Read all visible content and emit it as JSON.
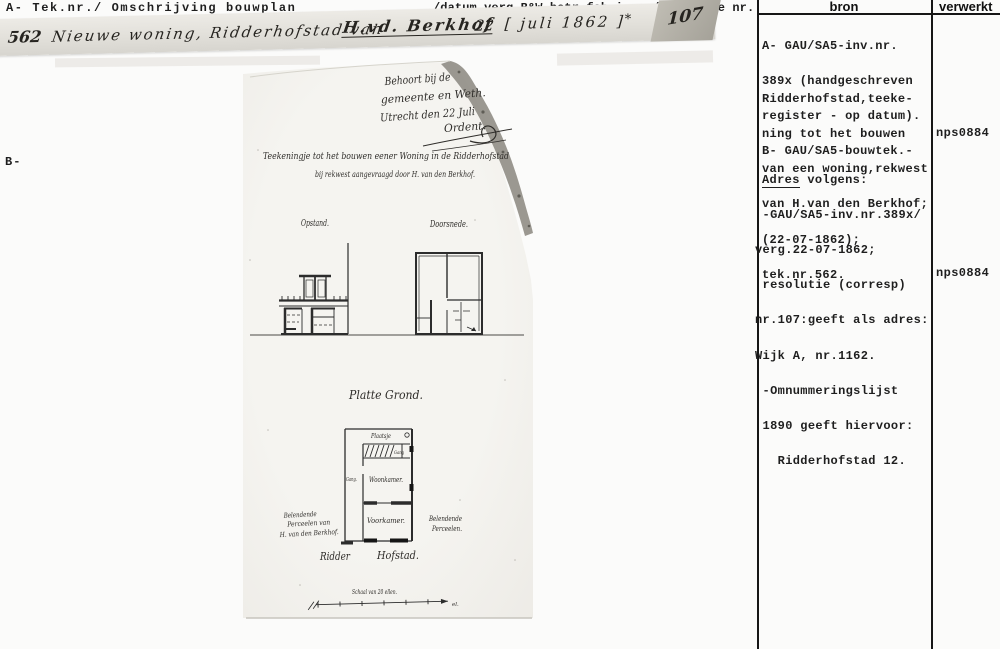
{
  "header": {
    "left": "A- Tek.nr./ Omschrijving bouwplan",
    "middle": "/datum verg.B&W.betr.fabricage/resolutie nr.",
    "bron": "bron",
    "verwerkt": "verwerkt",
    "b_label": "B-"
  },
  "entry": {
    "tek_nr": "562",
    "text": "Nieuwe woning, Ridderhofstad van",
    "name": "H.vd. Berkhof",
    "day": "22",
    "date": "[ juli 1862 ]",
    "mark": "*",
    "resolutie": "107"
  },
  "bron": {
    "block1": {
      "0": "A- GAU/SA5-inv.nr.",
      "1": "389x (handgeschreven",
      "2": "register - op datum).",
      "3": "B- GAU/SA5-bouwtek.-"
    },
    "block2": {
      "0": "Ridderhofstad,teeke-",
      "1": "ning tot het bouwen",
      "2": "van een woning,rekwest",
      "3": "van H.van den Berkhof;",
      "4": "(22-07-1862);",
      "5": "tek.nr.562."
    },
    "adres_word": "Adres",
    "adres_rest": " volgens:",
    "block3": {
      "0": " -GAU/SA5-inv.nr.389x/",
      "1": "verg.22-07-1862;",
      "2": " resolutie (corresp)",
      "3": "nr.107:geeft als adres:",
      "4": "Wijk A, nr.1162.",
      "5": " -Omnummeringslijst",
      "6": " 1890 geeft hiervoor:",
      "7": "   Ridderhofstad 12."
    }
  },
  "verwerkt": {
    "code1": "nps0884",
    "code2": "nps0884"
  },
  "drawing": {
    "stamp1": "Behoort bij de",
    "stamp2": "gemeente en Weth.",
    "stamp3": "Utrecht den 22 Juli",
    "stamp4": "Ordent.",
    "title": "Teekeningje tot het bouwen eener Woning in de Ridderhofstad",
    "subtitle": "bij rekwest aangevraagd door H. van den Berkhof.",
    "opstand": "Opstand.",
    "doorsnede": "Doorsnede.",
    "plan_title": "Platte Grond.",
    "plaatsje": "Plaatsje",
    "gang_cell": "Gang",
    "gang": "Gang.",
    "woonkamer": "Woonkamer.",
    "voorkamer": "Voorkamer.",
    "left_adjacent1": "Belendende",
    "left_adjacent2": "Perceelen van",
    "left_adjacent3": "H. van den Berkhof.",
    "right_adjacent1": "Belendende",
    "right_adjacent2": "Perceelen.",
    "street_1": "Ridder",
    "street_2": "Hofstad.",
    "scale": "Schaal van 20 ellen.",
    "scale_end": "el."
  }
}
